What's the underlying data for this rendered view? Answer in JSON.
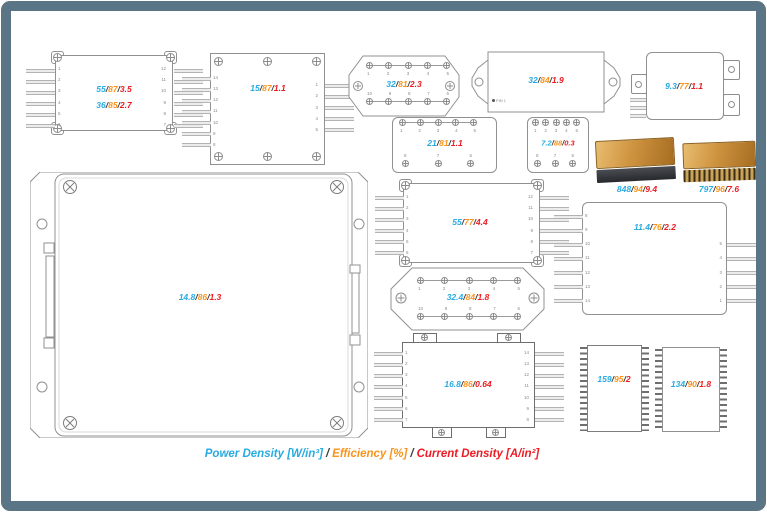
{
  "sep": "/",
  "colors": {
    "power": "#29abe2",
    "efficiency": "#f7941d",
    "current": "#ed1c24",
    "frame": "#5a7585"
  },
  "legend": {
    "power": "Power Density [W/in³]",
    "efficiency": "Efficiency [%]",
    "current": "Current Density [A/in²]"
  },
  "modules": {
    "a": {
      "lines": [
        {
          "p": "55",
          "e": "87",
          "c": "3.5"
        },
        {
          "p": "36",
          "e": "85",
          "c": "2.7"
        }
      ],
      "pins_left": [
        "1",
        "2",
        "3",
        "4",
        "5",
        "6"
      ],
      "pins_right": [
        "12",
        "11",
        "10",
        "9",
        "8",
        "7"
      ]
    },
    "b": {
      "line": {
        "p": "15",
        "e": "87",
        "c": "1.1"
      },
      "pins_left": [
        "14",
        "13",
        "12",
        "11",
        "10",
        "9",
        "8"
      ],
      "pins_right": [
        "1",
        "2",
        "3",
        "4",
        "5"
      ]
    },
    "c": {
      "line": {
        "p": "32",
        "e": "81",
        "c": "2.3"
      },
      "pins_top": [
        "1",
        "2",
        "3",
        "4",
        "5"
      ],
      "pins_bottom": [
        "10",
        "9",
        "8",
        "7",
        "6"
      ]
    },
    "d": {
      "line": {
        "p": "32",
        "e": "84",
        "c": "1.9"
      },
      "pin1": "PIN 1"
    },
    "e": {
      "line": {
        "p": "9.3",
        "e": "77",
        "c": "1.1"
      }
    },
    "f": {
      "line": {
        "p": "21",
        "e": "81",
        "c": "1.1"
      },
      "pins_top": [
        "1",
        "2",
        "3",
        "4",
        "5"
      ],
      "pins_bottom": [
        "8",
        "7",
        "6"
      ]
    },
    "g": {
      "line": {
        "p": "7.2",
        "e": "88",
        "c": "0.3"
      },
      "pins_top": [
        "1",
        "2",
        "3",
        "4",
        "5"
      ],
      "pins_bottom": [
        "8",
        "7",
        "6"
      ]
    },
    "h": {
      "line": {
        "p": "848",
        "e": "94",
        "c": "9.4"
      }
    },
    "i": {
      "line": {
        "p": "797",
        "e": "96",
        "c": "7.6"
      }
    },
    "j": {
      "line": {
        "p": "14.8",
        "e": "86",
        "c": "1.3"
      }
    },
    "k": {
      "line": {
        "p": "55",
        "e": "77",
        "c": "4.4"
      },
      "pins_left": [
        "1",
        "2",
        "3",
        "4",
        "5",
        "6"
      ],
      "pins_right": [
        "12",
        "11",
        "10",
        "9",
        "8",
        "7"
      ]
    },
    "l": {
      "line": {
        "p": "32.4",
        "e": "84",
        "c": "1.8"
      },
      "pins_top": [
        "1",
        "2",
        "3",
        "4",
        "5"
      ],
      "pins_bottom": [
        "10",
        "9",
        "8",
        "7",
        "6"
      ]
    },
    "m": {
      "line": {
        "p": "11.4",
        "e": "76",
        "c": "2.2"
      },
      "pins_left": [
        "8",
        "9",
        "10",
        "11",
        "12",
        "13",
        "14"
      ],
      "pins_right": [
        "5",
        "4",
        "3",
        "2",
        "1"
      ]
    },
    "n": {
      "line": {
        "p": "16.8",
        "e": "86",
        "c": "0.64"
      },
      "pins_left": [
        "1",
        "2",
        "3",
        "4",
        "5",
        "6",
        "7"
      ],
      "pins_right": [
        "14",
        "13",
        "12",
        "11",
        "10",
        "9",
        "8"
      ]
    },
    "o": {
      "line": {
        "p": "159",
        "e": "95",
        "c": "2"
      }
    },
    "p": {
      "line": {
        "p": "134",
        "e": "90",
        "c": "1.8"
      }
    }
  }
}
